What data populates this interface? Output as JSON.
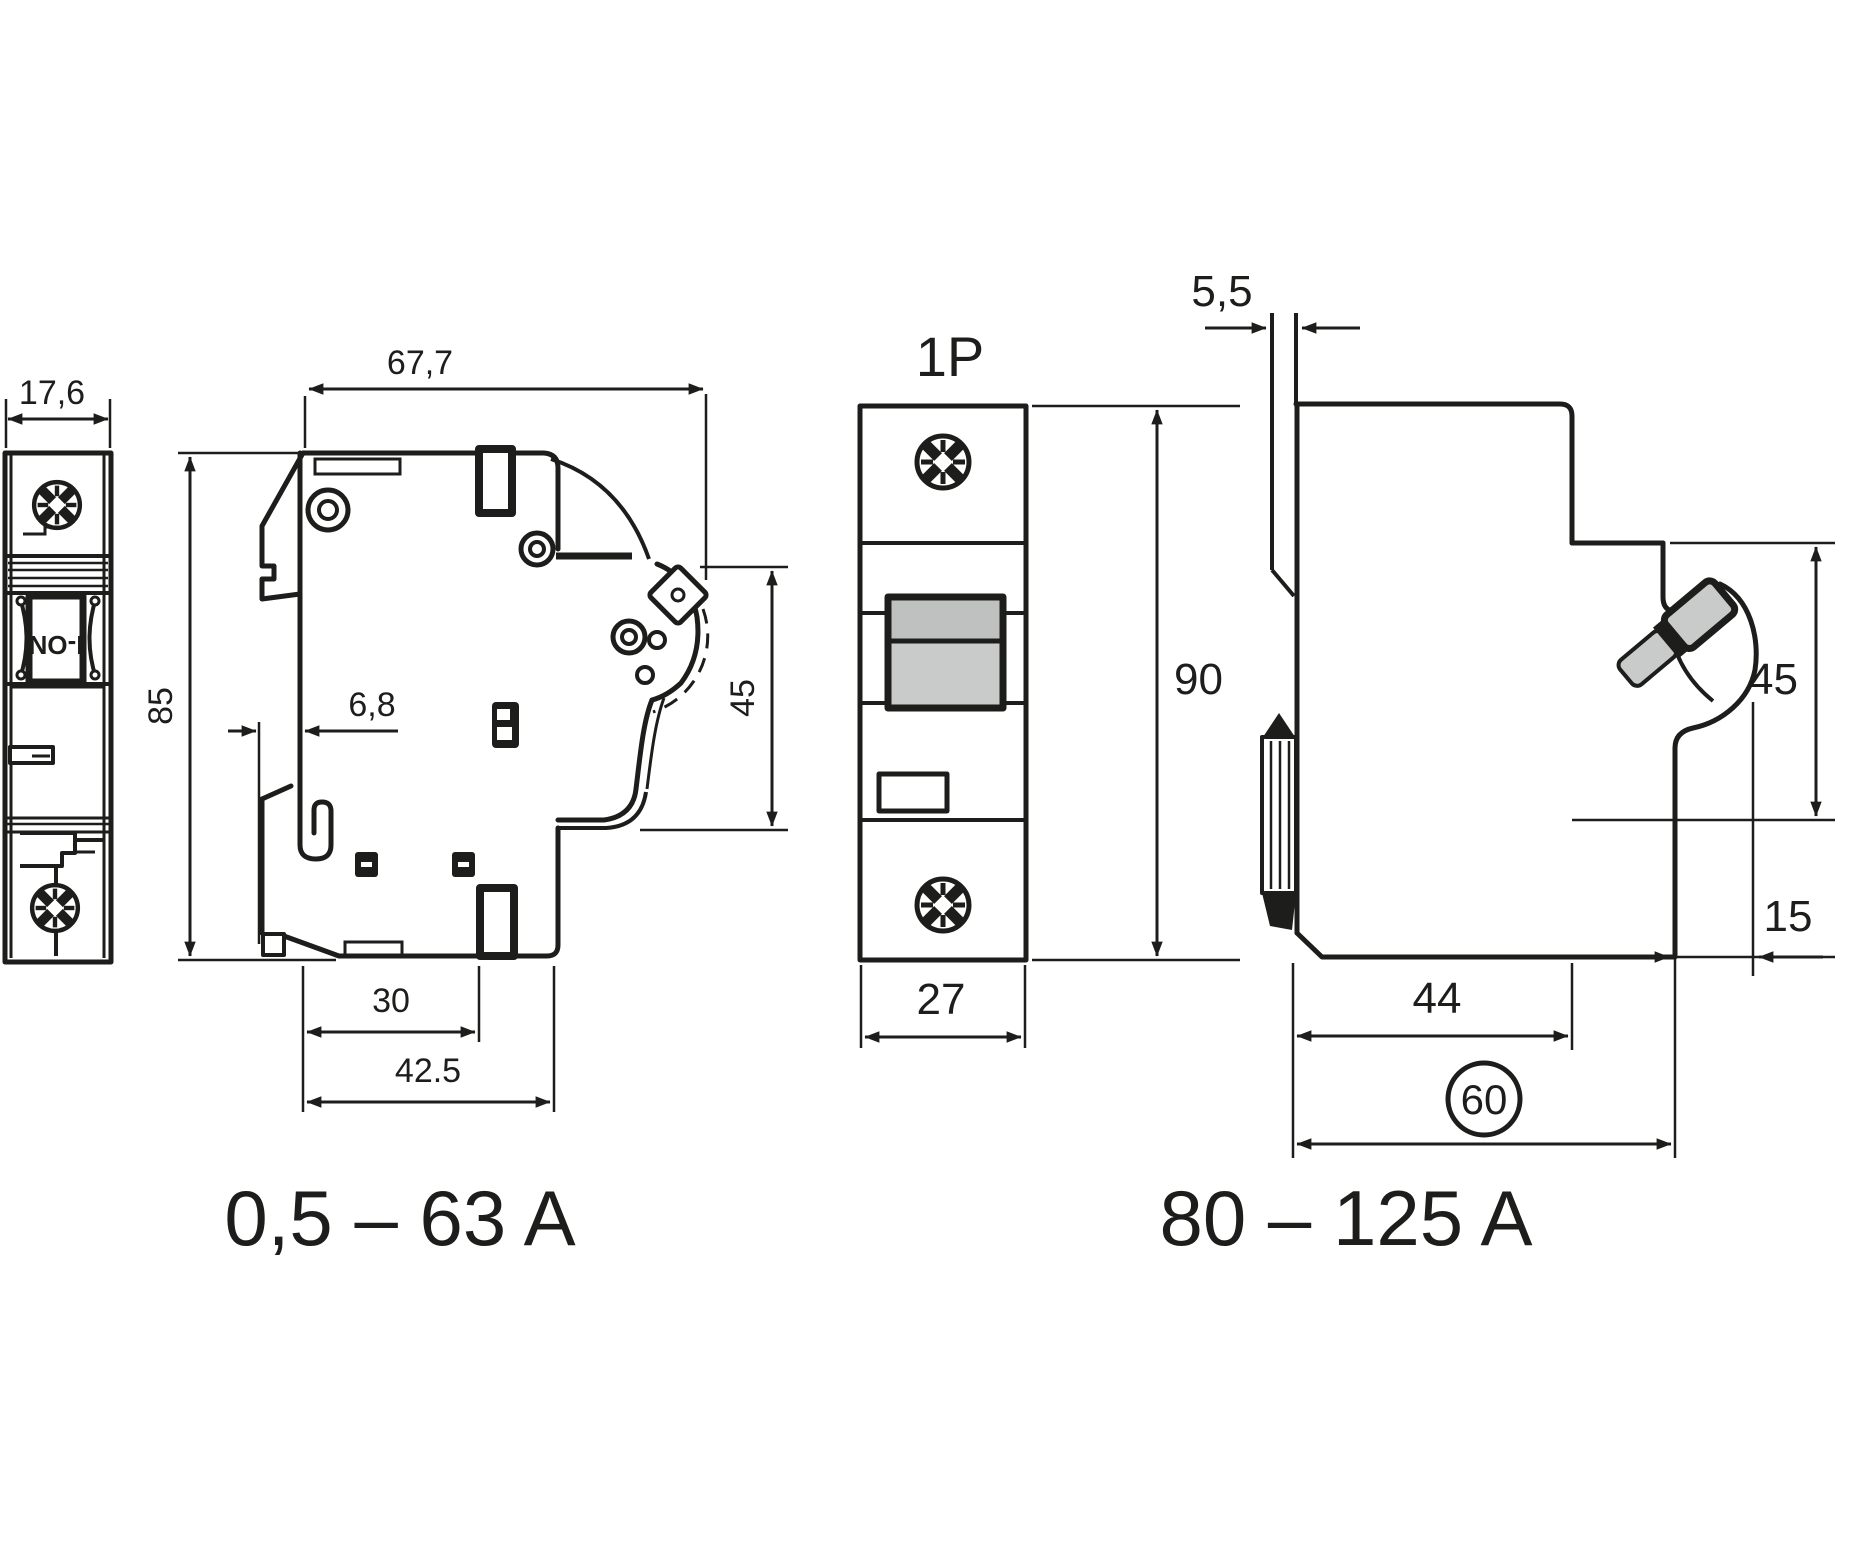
{
  "drawing": {
    "views": {
      "narrow": {
        "toggle_label": "I-ON",
        "dim_width": "17,6"
      },
      "side_small": {
        "dim_width": "67,7",
        "dim_height": "85",
        "dim_rail_offset": "6,8",
        "dim_handle_height": "45",
        "dim_slot": "30",
        "dim_depth": "42.5",
        "label": "0,5 – 63 A"
      },
      "front": {
        "title": "1P",
        "dim_width": "27",
        "dim_height": "90"
      },
      "side_large": {
        "dim_plate": "5,5",
        "dim_handle_height": "45",
        "dim_front": "15",
        "dim_body_depth": "44",
        "dim_total_depth": "60",
        "label": "80 – 125 A"
      }
    },
    "colors": {
      "line": "#1d1d1b",
      "toggle_gray": "#c9cbca",
      "toggle_gray_dark": "#bfc1c0"
    }
  }
}
